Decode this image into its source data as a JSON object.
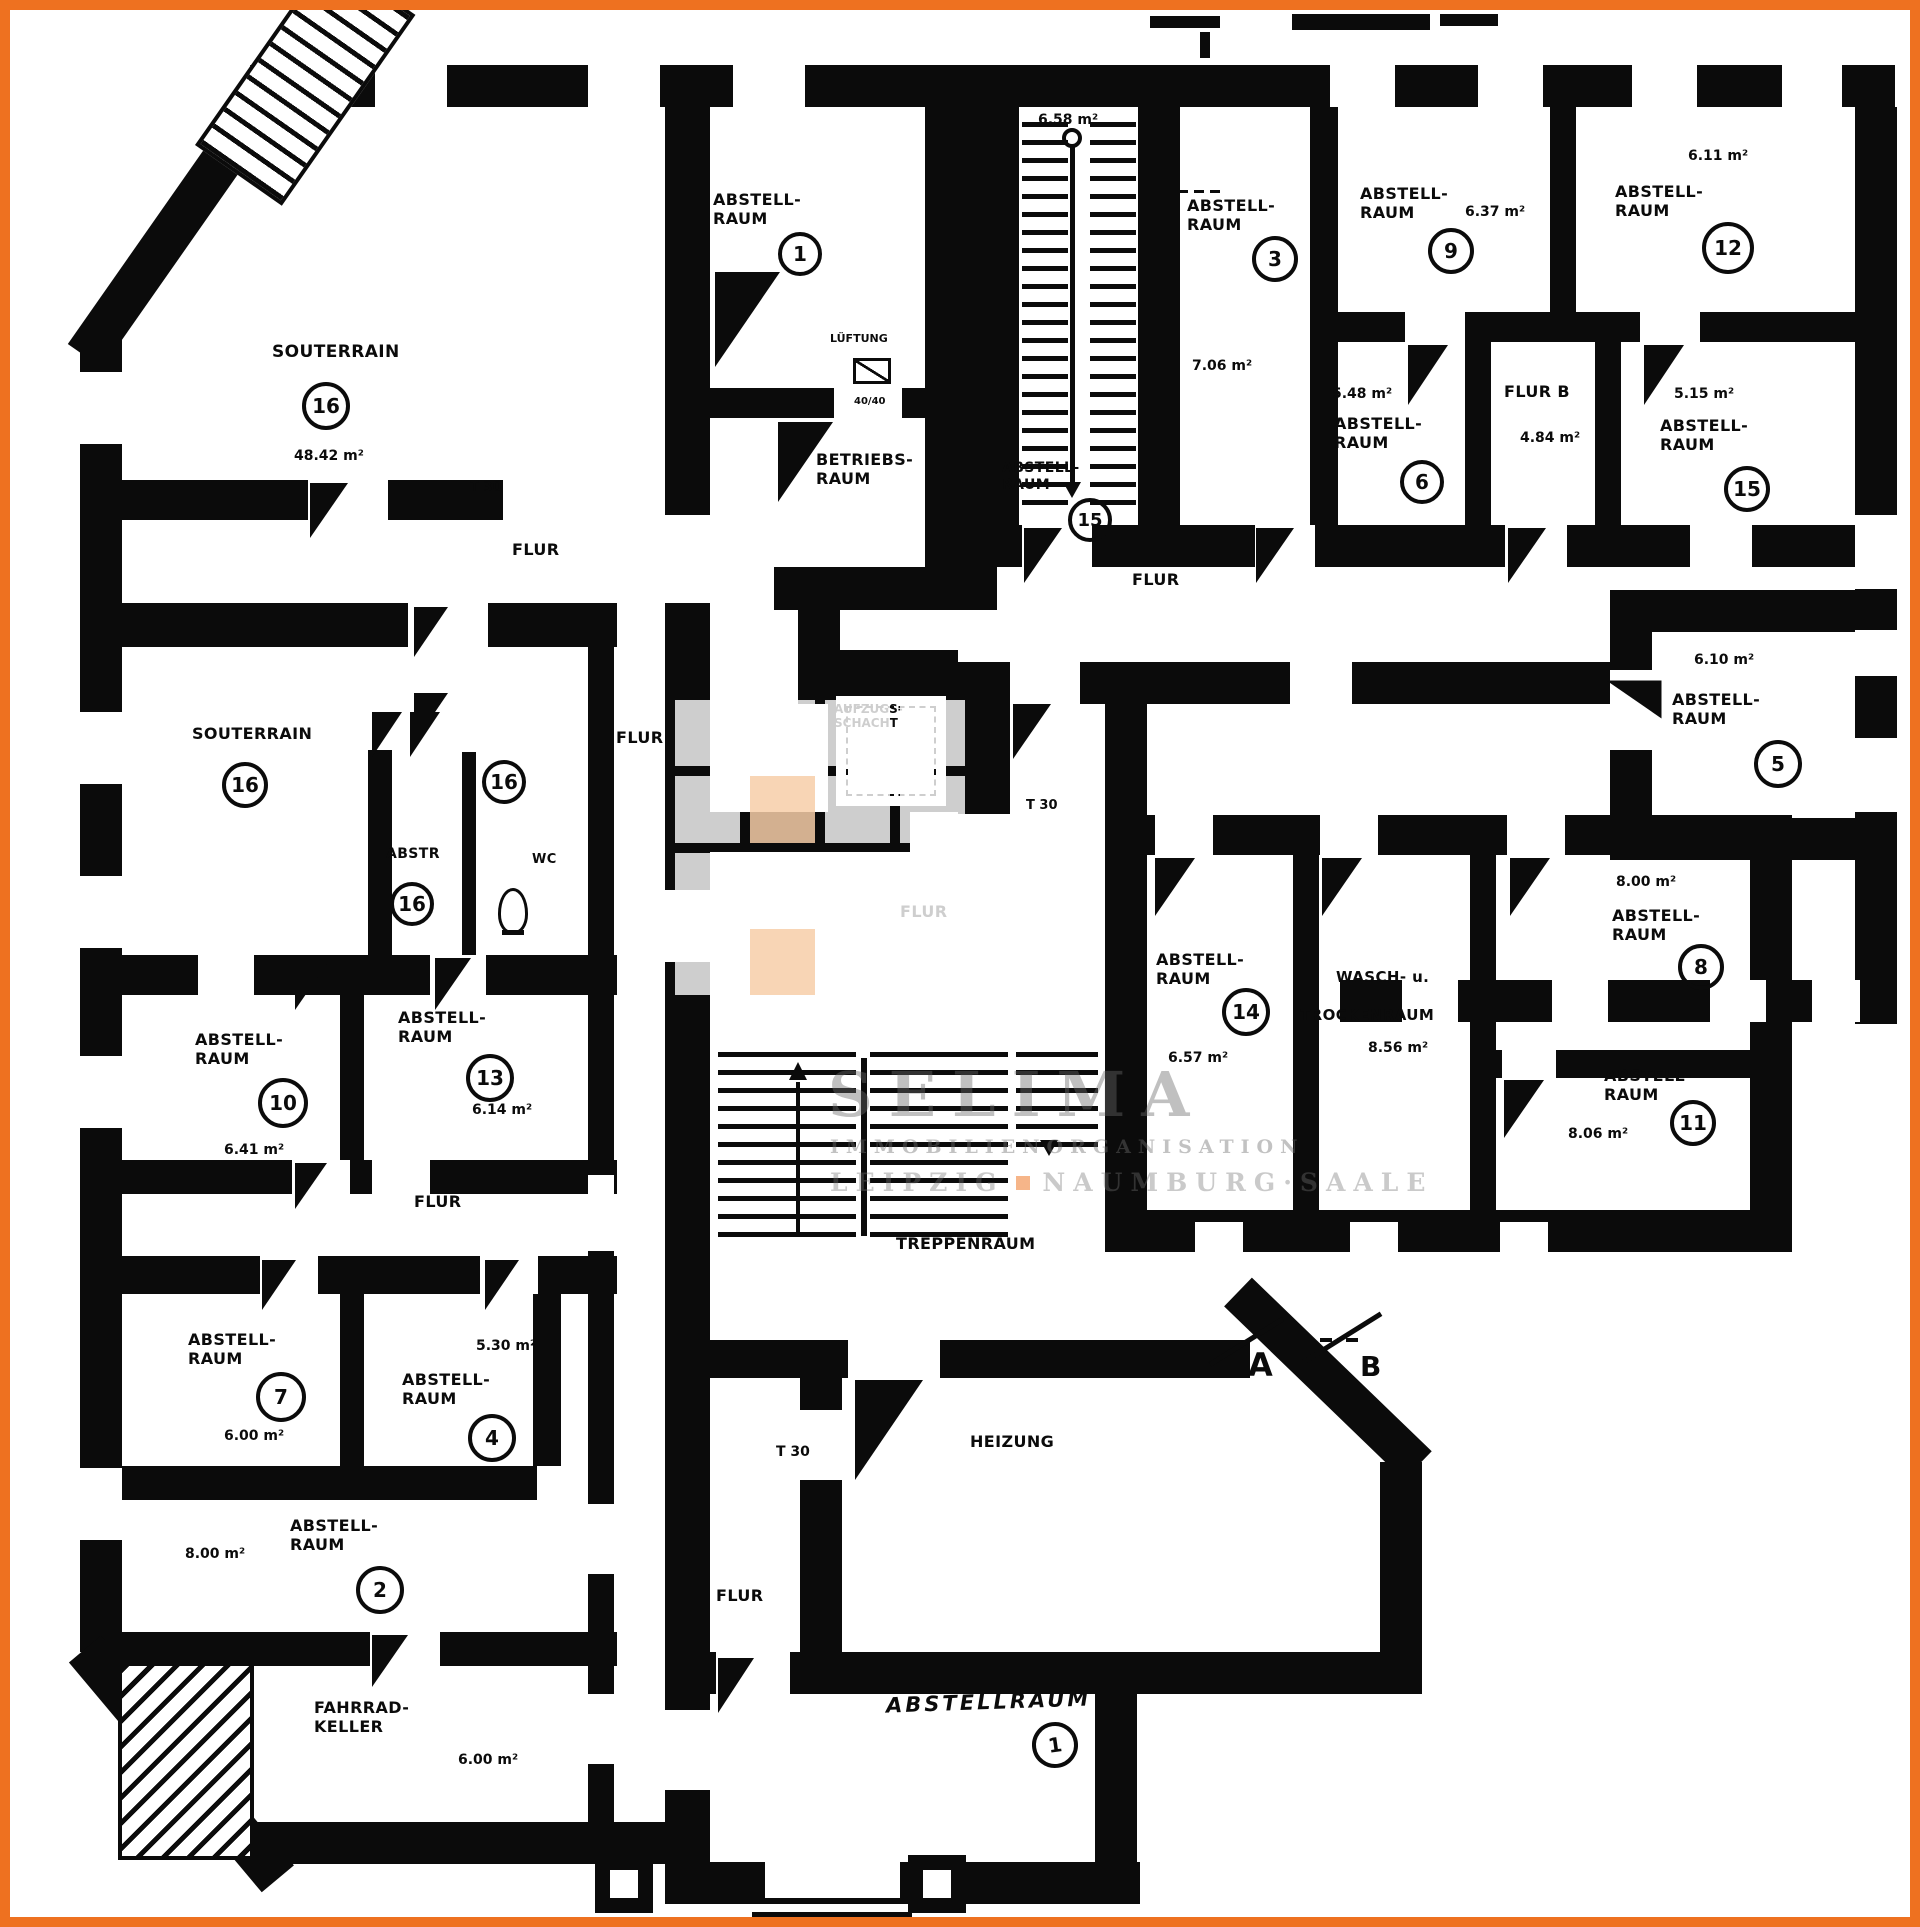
{
  "watermark": {
    "name": "SELIMA",
    "line1": "IMMOBILIENORGANISATION",
    "city1": "LEIPZIG",
    "city2": "NAUMBURG·SAALE"
  },
  "labels": {
    "flur": "FLUR",
    "flur_b": "FLUR B",
    "t30": "T 30",
    "treppenraum": "TREPPENRAUM",
    "heizung": "HEIZUNG",
    "wc": "WC",
    "abstr": "ABSTR",
    "souterrain": "SOUTERRAIN",
    "lueftung": "LÜFTUNG",
    "lueftung_size": "40/40",
    "abstell_l1": "ABSTELL-",
    "abstell_l2": "RAUM",
    "betriebs_l1": "BETRIEBS-",
    "betriebs_l2": "RAUM",
    "aufzug_l1": "AUFZUGS-",
    "aufzug_l2": "SCHACHT",
    "wasch_l1": "WASCH- u.",
    "wasch_l2": "TROCKENRAUM",
    "fahrrad_l1": "FAHRRAD-",
    "fahrrad_l2": "KELLER",
    "abstellraum_hand": "ABSTELLRAUM",
    "section_a": "A",
    "section_b": "B"
  },
  "rooms": {
    "r1": {
      "num": "1"
    },
    "r2": {
      "num": "2",
      "area": "8.00 m²"
    },
    "r3": {
      "num": "3",
      "area": "7.06 m²"
    },
    "r4": {
      "num": "4",
      "area": "5.30 m²"
    },
    "r5": {
      "num": "5",
      "area": "6.10 m²"
    },
    "r6": {
      "num": "6",
      "area": "5.48 m²"
    },
    "r7": {
      "num": "7",
      "area": "6.00 m²"
    },
    "r8": {
      "num": "8",
      "area": "8.00 m²"
    },
    "r9": {
      "num": "9",
      "area": "6.37 m²"
    },
    "r10": {
      "num": "10",
      "area": "6.41 m²"
    },
    "r11": {
      "num": "11",
      "area": "8.06 m²"
    },
    "r12": {
      "num": "12",
      "area": "6.11 m²"
    },
    "r13": {
      "num": "13",
      "area": "6.14 m²"
    },
    "r14": {
      "num": "14",
      "area": "6.57 m²"
    },
    "r15": {
      "num": "15",
      "area": "5.15 m²"
    },
    "r15s": {
      "num": "15",
      "area": "6.58 m²"
    },
    "r16": {
      "num": "16",
      "area": "48.42 m²"
    },
    "flurb": {
      "area": "4.84 m²"
    },
    "wasch": {
      "area": "8.56 m²"
    },
    "fahrrad": {
      "area": "6.00 m²"
    },
    "hand": {
      "num": "1"
    }
  }
}
